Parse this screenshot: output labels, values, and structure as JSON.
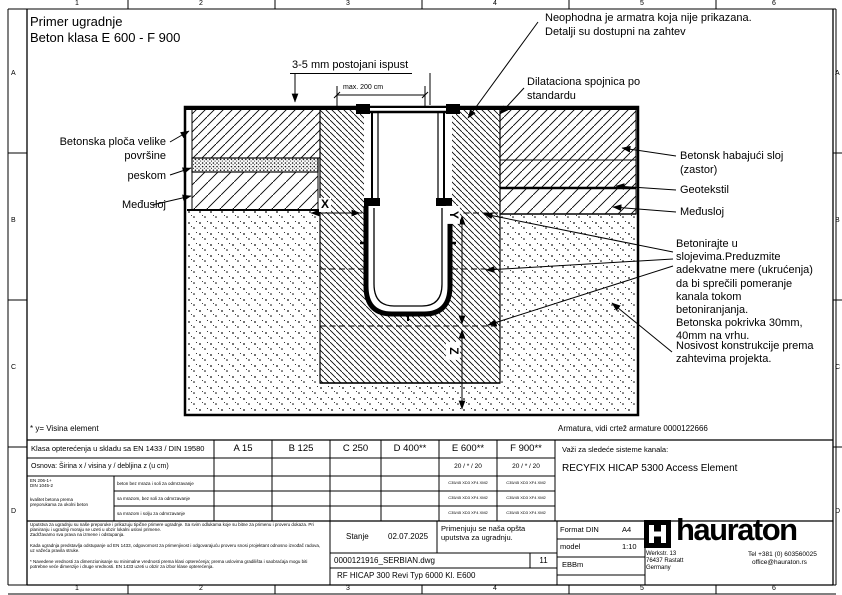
{
  "sheet": {
    "cols": [
      "1",
      "2",
      "3",
      "4",
      "5",
      "6"
    ],
    "rows": [
      "A",
      "B",
      "C",
      "D"
    ],
    "title1": "Primer ugradnje",
    "title2": "Beton klasa E 600 - F 900"
  },
  "callouts": {
    "ispust": "3-5 mm postojani ispust",
    "max_dim": "max. 200 cm",
    "neophodna1": "Neophodna je armatra koja nije prikazana.",
    "neophodna2": "Detalji su dostupni na zahtev",
    "dilataciona1": "Dilataciona spojnica po",
    "dilataciona2": "standardu",
    "left1a": "Betonska ploča velike",
    "left1b": "površine",
    "left2": "peskom",
    "left3": "Međusloj",
    "right1a": "Betonsk habajući sloj",
    "right1b": "(zastor)",
    "right2": "Geotekstil",
    "right3": "Međusloj",
    "betonirajte": "Betonirajte u\nslojevima.Preduzmite\nadekvatne mere (ukrućenja)\nda bi sprečili pomeranje\nkanala tokom\nbetoniranjanja.\nBetonska pokrivka 30mm,\n40mm na vrhu.",
    "nosivost": "Nosivost konstrukcije prema\nzahtevima projekta.",
    "dim_x": "X",
    "dim_y": "Y",
    "dim_z": "Z"
  },
  "notes": {
    "visina": "* y= Visina element",
    "armatura": "Armatura, vidi crtež armature 0000122666"
  },
  "table": {
    "header": "Klasa opterećenja u skladu sa EN 1433 / DIN 19580",
    "classes": [
      "A 15",
      "B 125",
      "C 250",
      "D 400**",
      "E 600**",
      "F 900**"
    ],
    "row2_label": "Osnova: Širina x / visina y / debljina z (u cm)",
    "dims": "20 / * / 20",
    "std1": "EN 206-1+",
    "std2": "DIN 1045-2",
    "std_note1": "kvalitet betona prema",
    "std_note2": "preporukama za okolni beton",
    "row3": "beton bez mraza i soli za odmrzavanje",
    "row4": "sa mrazom, bez soli za odmrzavanje",
    "row5": "sa mrazom i solju za odmrzavanje",
    "exposure": "C35/45 XD3 XF4 XM2"
  },
  "system": {
    "applies": "Važi za sledeće sisteme kanala:",
    "name": "RECYFIX HICAP 5300 Access Element"
  },
  "titleblock": {
    "legal1": "Uputstva za ugradnju su naše preporuke i prikazuju tipične primere ugradnje. Sa svim odlukama koje su bitne za primenu i proveru dokaza. Pri planiranju i ugradnji moraju se uzeti u obzir lokalni uslovi primene.\nZadržavamo sva prava na izmene i odstupanja.",
    "legal2": "Kada ugradnja predstavlja odstupanje od EN 1433, odgovornost za primenjivost i odgovarajuću proveru snosi projektant odnosno izvođač radova, uz važeća pravila struke.",
    "legal3": "* Navedene vrednosti za dimenzionisanje su minimalne vrednosti prema klasi opterećenja; prema uslovima gradilišta i saobraćaja mogu biti potrebne veće dimenzije i druge vrednosti. EN 1433 uzeti u obzir za izbor klase opterećenja.",
    "stanje_label": "Stanje",
    "stanje_value": "02.07.2025",
    "uputstva": "Primenjuju se naša opšta uputstva za ugradnju.",
    "file": "0000121916_SERBIAN.dwg",
    "sheet_no": "11",
    "drawing_name": "RF HICAP 300 Revi Typ 6000 Kl. E600",
    "format_label": "Format DIN",
    "format_value": "A4",
    "scale_label": "model",
    "scale_value": "1:10",
    "code": "EBBm"
  },
  "brand": {
    "wordmark": "hauraton",
    "addr1": "Werkstr. 13",
    "addr2": "76437 Rastatt",
    "addr3": "Germany",
    "tel": "Tel +381 (0) 603560025",
    "email": "office@hauraton.rs"
  }
}
